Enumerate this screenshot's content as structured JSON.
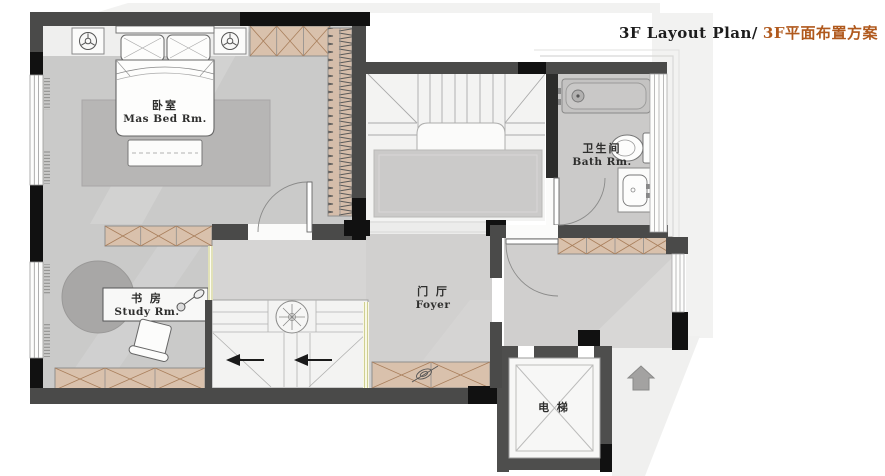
{
  "title": {
    "en": "3F Layout Plan/",
    "zh": "3F平面布置方案"
  },
  "rooms": {
    "master_bedroom": {
      "zh": "卧室",
      "en": "Mas Bed Rm."
    },
    "study": {
      "zh": "书 房",
      "en": "Study Rm."
    },
    "bathroom": {
      "zh": "卫生间",
      "en": "Bath Rm."
    },
    "foyer": {
      "zh": "门 厅",
      "en": "Foyer"
    },
    "elevator": {
      "zh": "电 梯"
    }
  },
  "colors": {
    "accent_title": "#b0591d",
    "wall_dark": "#4a4a49",
    "wall_black": "#111111",
    "floor_gray": "#cacac9",
    "floor_light": "#f3f3f2",
    "rug_gray": "#b7b6b5",
    "cabinet_tan": "#d9c1ac",
    "cabinet_line": "#a97f5c",
    "glass_partition": "#cfcf92",
    "backdrop": "#f2f2f1"
  },
  "icons": {
    "table-lamp-icon": "circle-with-spokes",
    "ceiling-lamp-icon": "circle-with-star",
    "desk-lamp-icon": "swing-arm-lamp",
    "plant-icon": "leaf-sprig",
    "up-arrow-icon": "solid-up-arrow"
  }
}
